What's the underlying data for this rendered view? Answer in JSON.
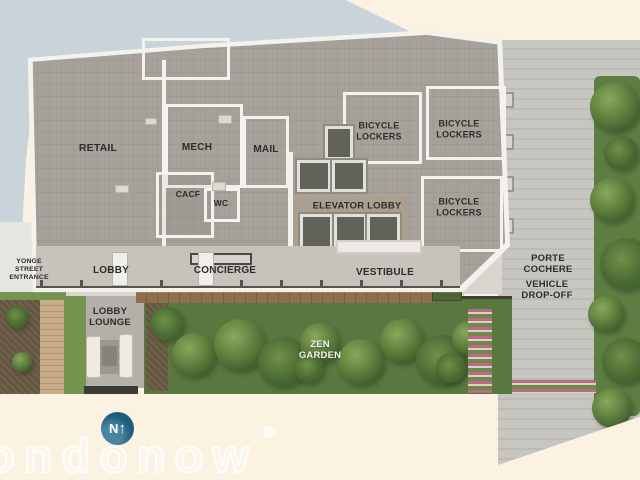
{
  "plan": {
    "rooms": [
      {
        "key": "retail",
        "label": "RETAIL"
      },
      {
        "key": "mech",
        "label": "MECH"
      },
      {
        "key": "mail",
        "label": "MAIL"
      },
      {
        "key": "cacf",
        "label": "CACF"
      },
      {
        "key": "wc",
        "label": "WC"
      },
      {
        "key": "bicycle_lockers_a",
        "label": "BICYCLE\nLOCKERS"
      },
      {
        "key": "bicycle_lockers_b",
        "label": "BICYCLE\nLOCKERS"
      },
      {
        "key": "bicycle_lockers_c",
        "label": "BICYCLE\nLOCKERS"
      },
      {
        "key": "elevator_lobby",
        "label": "ELEVATOR LOBBY"
      },
      {
        "key": "lobby",
        "label": "LOBBY"
      },
      {
        "key": "concierge",
        "label": "CONCIERGE"
      },
      {
        "key": "vestibule",
        "label": "VESTIBULE"
      },
      {
        "key": "lobby_lounge",
        "label": "LOBBY\nLOUNGE"
      }
    ],
    "outdoor": [
      {
        "key": "yonge_street_entrance",
        "label": "YONGE\nSTREET\nENTRANCE"
      },
      {
        "key": "porte_cochere",
        "label": "PORTE\nCOCHERE"
      },
      {
        "key": "vehicle_dropoff",
        "label": "VEHICLE\nDROP-OFF"
      },
      {
        "key": "zen_garden",
        "label": "ZEN\nGARDEN"
      }
    ],
    "compass": {
      "letter": "N",
      "arrow": "↑"
    },
    "watermark": {
      "text": "ondonow",
      "mark": "®"
    },
    "colors": {
      "street": "#c9d3da",
      "paper": "#fbf2e2",
      "floor": "#a6a29b",
      "walls": "#f3f2ed",
      "garden": "#587840",
      "driveway": "#c8c6c1",
      "compass": "#1d5d7b"
    }
  }
}
